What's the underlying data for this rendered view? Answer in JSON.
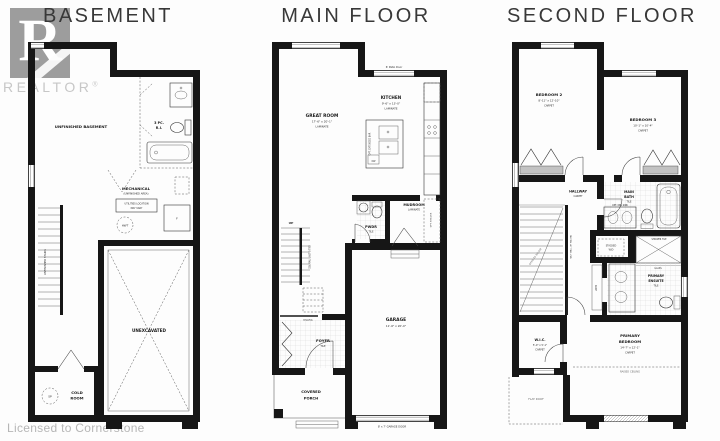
{
  "brand": {
    "logo_letter": "R",
    "logo_word": "REALTOR",
    "registered": "®",
    "license": "Licensed to Cornerstone"
  },
  "titles": {
    "basement": "BASEMENT",
    "main": "MAIN FLOOR",
    "second": "SECOND FLOOR"
  },
  "basement": {
    "room": "UNFINISHED BASEMENT",
    "bath1": "3 PC.",
    "bath2": "R.I.",
    "mech1": "MECHANICAL",
    "mech2": "(UNFINISHED AREA)",
    "util1": "UTILITIES LOCATION",
    "util2": "MAY VARY",
    "hwt": "HWT",
    "furnace": "F",
    "unexcavated": "UNEXCAVATED",
    "cold1": "COLD",
    "cold2": "ROOM",
    "sump": "SP",
    "stairs": "UNFINISHED STAIRS"
  },
  "main": {
    "patio": "6' Patio Door",
    "great_name": "GREAT ROOM",
    "great_dim": "17'-6\" x 20'-1\"",
    "great_floor": "LAMINATE",
    "kitchen_name": "KITCHEN",
    "kitchen_dim": "9'-6\" x 13'-0\"",
    "kitchen_floor": "LAMINATE",
    "island": "OPT. EXTENDED BAR",
    "dw": "DW",
    "mud_name": "MUDROOM",
    "mud_floor": "LAMINATE",
    "pwdr_name": "PWDR",
    "pwdr_floor": "TILE",
    "closet": "OPT. SHELVES",
    "up": "UP",
    "rail": "RAILING",
    "stair_note": "DBL RAIL LAST 3 TRD",
    "foyer_name": "FOYER",
    "foyer_floor": "TILE",
    "porch1": "COVERED",
    "porch2": "PORCH",
    "garage_name": "GARAGE",
    "garage_dim": "11'-6\" x 20'-0\"",
    "garage_door": "8' x 7' GARAGE DOOR"
  },
  "second": {
    "bed2_name": "BEDROOM 2",
    "bed2_dim": "8'-11\" x 12'-10\"",
    "bed2_floor": "CARPET",
    "bed3_name": "BEDROOM 3",
    "bed3_dim": "10'-1\" x 10'-4\"",
    "bed3_floor": "CARPET",
    "hall_name": "HALLWAY",
    "hall_floor": "CARPET",
    "bath1": "MAIN",
    "bath2": "BATH",
    "bath_floor": "TILE",
    "opt_sink": "OPT. DBL SINK",
    "wd1": "STACKED",
    "wd2": "W/D",
    "shower": "SHOWER TILE",
    "glass": "GLASS",
    "linen": "LINEN",
    "ens1": "PRIMARY",
    "ens2": "ENSUITE",
    "ens_floor": "TILE",
    "wic_name": "W.I.C.",
    "wic_dim": "5'-0\" x 5'-1\"",
    "wic_floor": "CARPET",
    "pbed1": "PRIMARY",
    "pbed2": "BEDROOM",
    "pbed_dim": "14'-7\" x 12'-1\"",
    "pbed_floor": "CARPET",
    "raised": "RAISED CEILING",
    "flat": "FLAT ROOF",
    "open_below": "OPEN TO BELOW",
    "half_wall": "HALF WALL W/ RAILING"
  }
}
